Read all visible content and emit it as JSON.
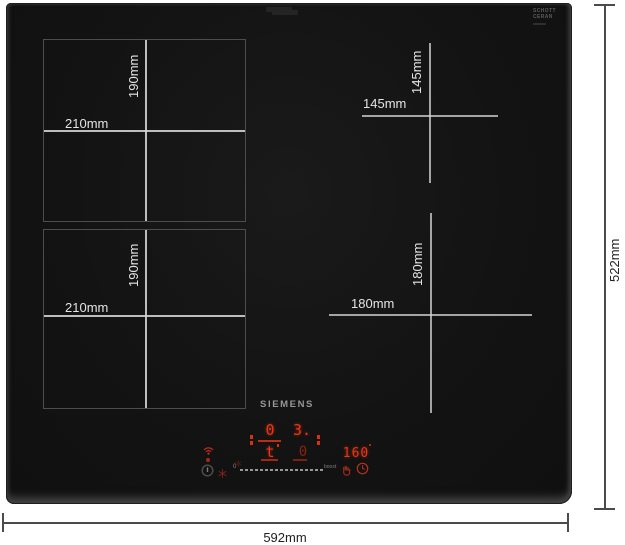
{
  "diagram": {
    "overall_width_label": "592mm",
    "overall_height_label": "522mm"
  },
  "zones": {
    "top_left": {
      "width_label": "210mm",
      "height_label": "190mm"
    },
    "bottom_left": {
      "width_label": "210mm",
      "height_label": "190mm"
    },
    "top_right": {
      "width_label": "145mm",
      "height_label": "145mm"
    },
    "bottom_right": {
      "width_label": "180mm",
      "height_label": "180mm"
    }
  },
  "hob": {
    "brand": "SIEMENS",
    "glass_brand_line1": "SCHOTT",
    "glass_brand_line2": "CERAN",
    "display": {
      "zone_left_top": "0",
      "zone_right_top": "3.",
      "zone_left_bottom": "t",
      "zone_right_bottom": "0",
      "temperature": "160",
      "slider_start": "0",
      "slider_end": "boost"
    },
    "icons": [
      "home-connect-icon",
      "status-dot",
      "power-icon",
      "freeze-icon",
      "spark-icon",
      "pause-hand-icon",
      "timer-clock-icon"
    ]
  },
  "colors": {
    "glass": "#141414",
    "display_red": "#ee3412",
    "dim_red": "#8e2110",
    "zone_line": "#d6d6d6",
    "dimension_line": "#4b4b4b"
  }
}
